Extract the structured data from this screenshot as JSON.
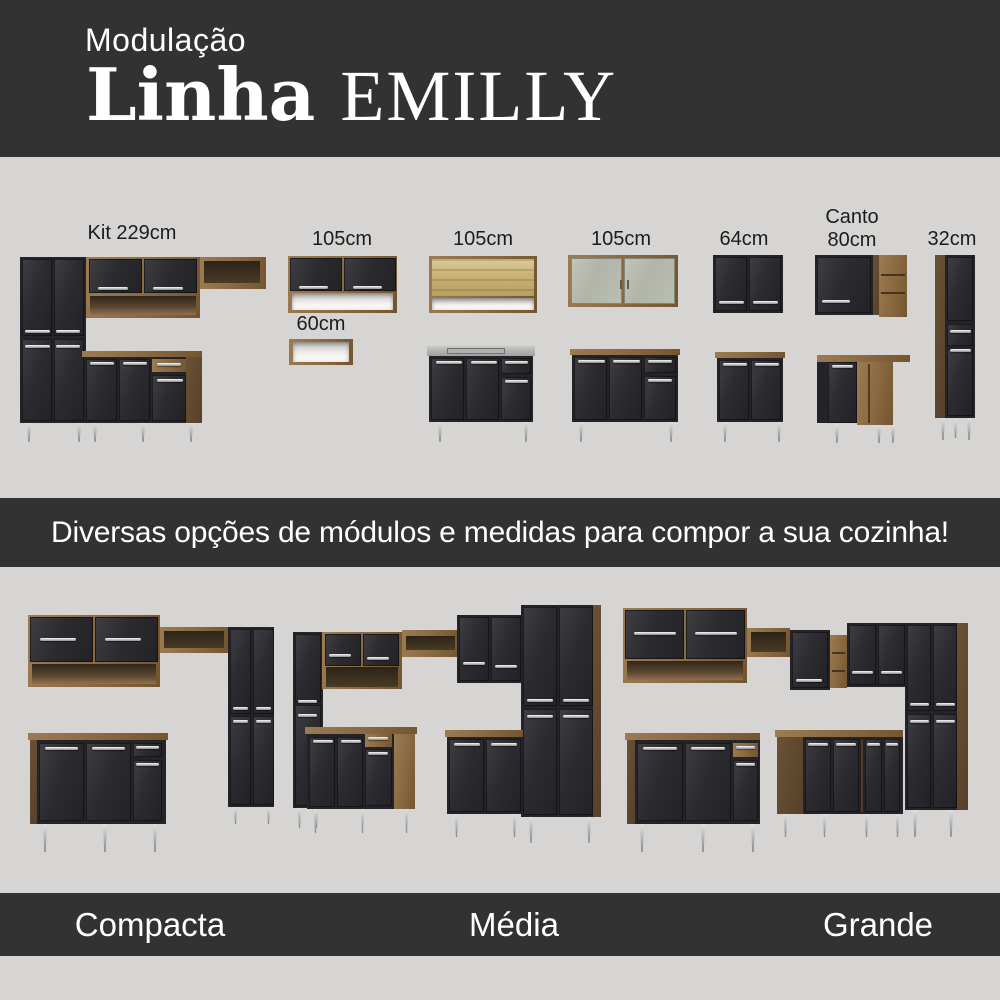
{
  "header": {
    "kicker": "Modulação",
    "title": "Linha",
    "title_accent": "EMILLY"
  },
  "modules": {
    "kit_label": "Kit 229cm",
    "wall105_label": "105cm",
    "niche60_label": "60cm",
    "open105_label": "105cm",
    "glass105_label": "105cm",
    "wall64_label": "64cm",
    "corner_label_line1": "Canto",
    "corner_label_line2": "80cm",
    "tall32_label": "32cm"
  },
  "banner": {
    "text": "Diversas opções de módulos e medidas para compor a sua cozinha!"
  },
  "footer": {
    "compacta": "Compacta",
    "media": "Média",
    "grande": "Grande"
  },
  "colors": {
    "band_bg": "#323232",
    "page_bg": "#d6d5d3",
    "cabinet_black": "#242428",
    "wood": "#8a6a42",
    "handle_silver": "#c9c9c9",
    "text_light": "#ffffff",
    "text_dark": "#1c1c1c"
  }
}
